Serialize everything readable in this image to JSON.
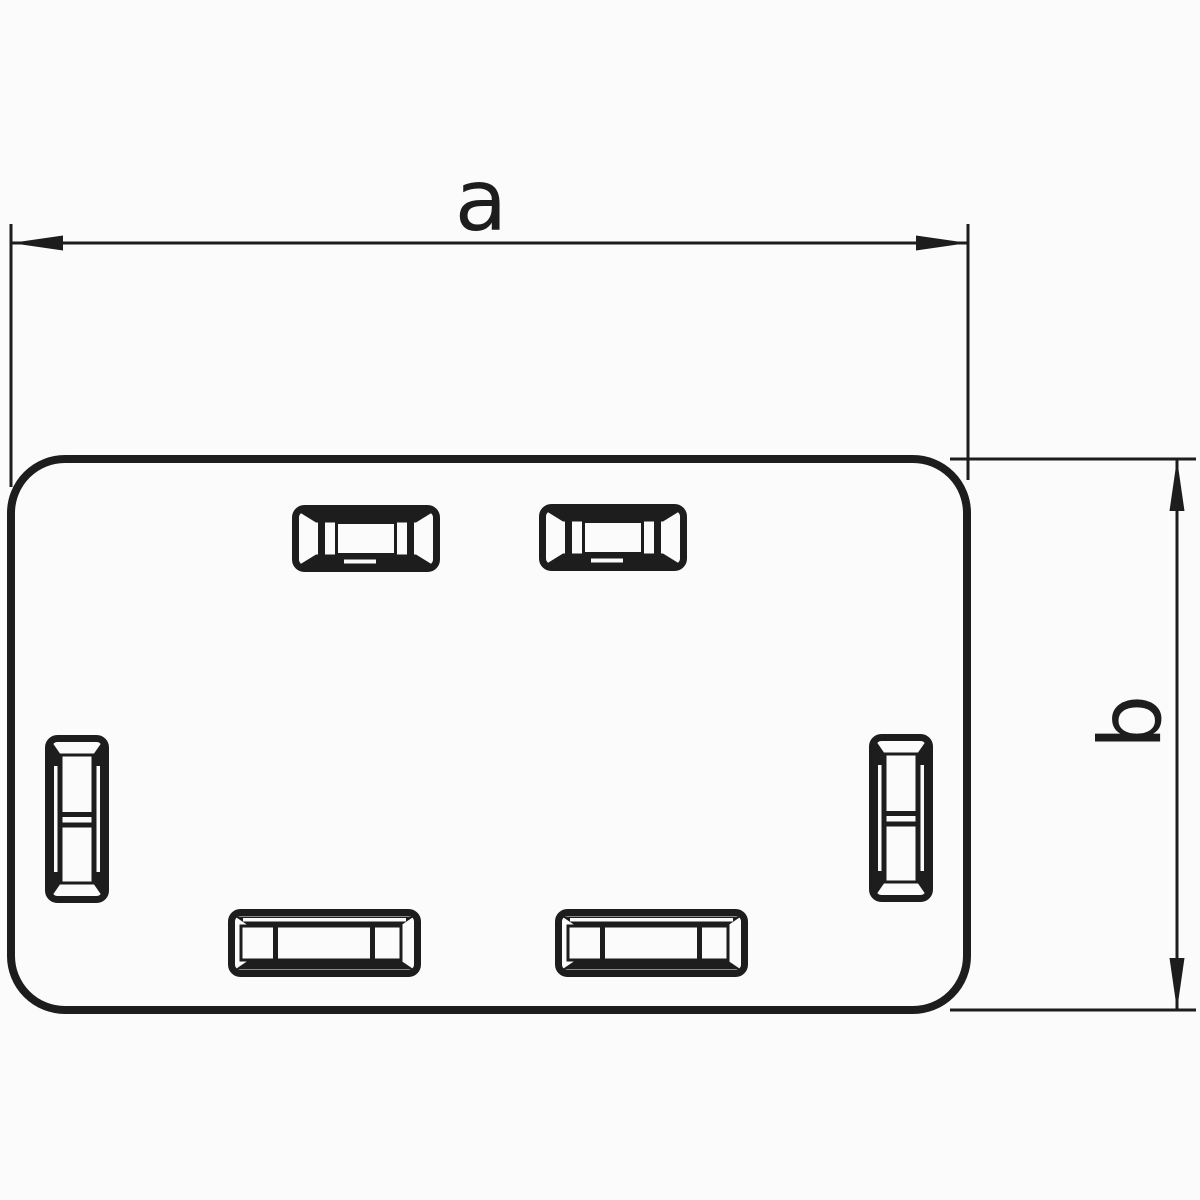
{
  "figure": {
    "kind": "technical outline drawing",
    "subject": "rectangular end plate with rounded corners and six latch slots",
    "background_color": "#fbfbfb",
    "line_color": "#1d1d1d",
    "dimensions": {
      "a": {
        "label": "a",
        "orientation": "horizontal",
        "position": "top"
      },
      "b": {
        "label": "b",
        "orientation": "vertical",
        "position": "right"
      }
    },
    "slots": {
      "top_count": 2,
      "bottom_count": 2,
      "left_count": 1,
      "right_count": 1,
      "total": 6
    }
  }
}
